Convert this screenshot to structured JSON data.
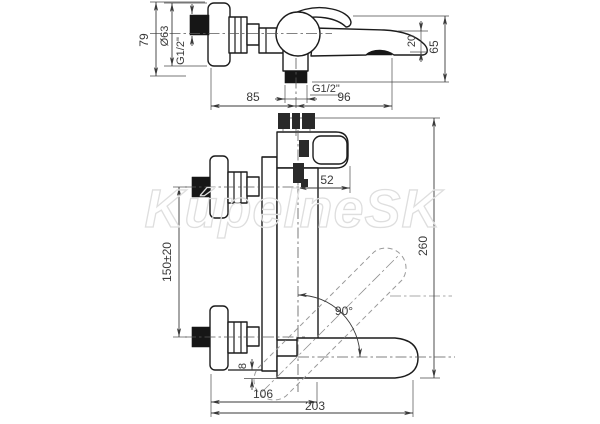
{
  "watermark": {
    "text": "KúpelneSK"
  },
  "colors": {
    "object_line": "#1c1c1c",
    "dimension_line": "#3a3a3a",
    "dashed_alternate_position": "#9a9a9a",
    "watermark_stroke": "#dedede",
    "thread_fill": "#161616"
  },
  "side_view": {
    "labels": {
      "height": "79",
      "flange_diameter": "Ø63",
      "wall_thread": "G1/2\"",
      "outlet_thread": "G1/2\"",
      "flange_to_outlet": "85",
      "outlet_to_spout": "96",
      "spout_tip": "20",
      "total_height": "65"
    }
  },
  "front_view": {
    "labels": {
      "handle_depth": "52",
      "connection_spacing": "150±20",
      "overall_length": "260",
      "swivel_angle": "90°",
      "bottom_offset": "8",
      "wall_to_body": "106",
      "overall_depth": "203"
    }
  }
}
